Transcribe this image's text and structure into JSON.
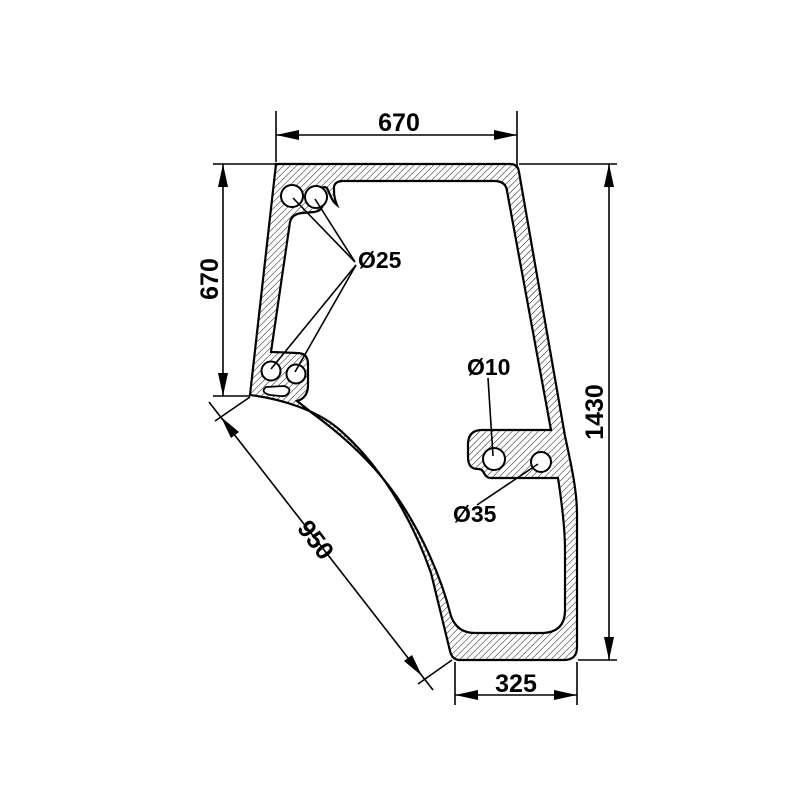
{
  "drawing": {
    "kind": "technical-dimension-drawing",
    "line_color": "#000000",
    "background_color": "#ffffff",
    "dimensions": {
      "top_width": "670",
      "left_height": "670",
      "right_height": "1430",
      "diagonal_length": "950",
      "bottom_width": "325"
    },
    "hole_labels": {
      "corner_holes_diameter": "Ø25",
      "small_hole_diameter": "Ø10",
      "large_hole_diameter": "Ø35"
    }
  }
}
